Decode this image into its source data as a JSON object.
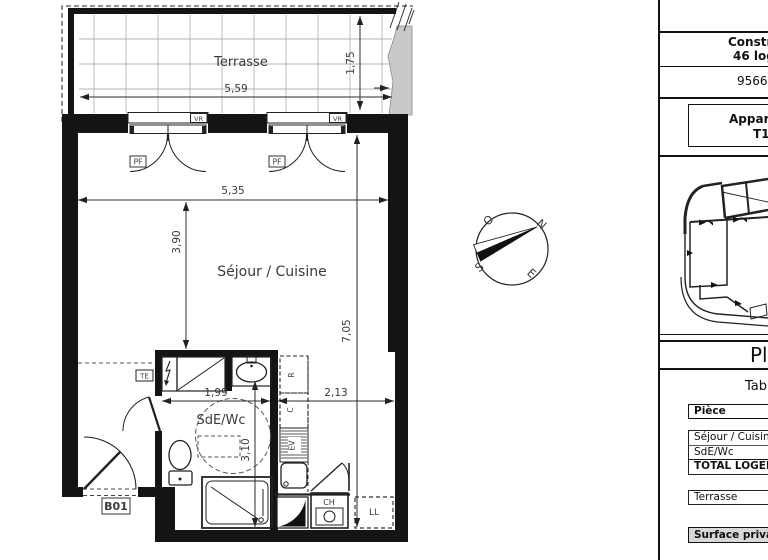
{
  "plan": {
    "room_labels": {
      "terrasse": "Terrasse",
      "sejour": "Séjour / Cuisine",
      "sde": "SdE/Wc"
    },
    "dims": {
      "terrace_w": "5,59",
      "terrace_d": "1,75",
      "living_w": "5,35",
      "living_d": "3,90",
      "total_d": "7,05",
      "sde_w": "1,99",
      "kitchen_w": "2,13",
      "sde_d": "3,10"
    },
    "tags": {
      "vr": "VR",
      "pf": "PF",
      "te": "TE",
      "fridge": "R",
      "c": "C",
      "ev": "EV",
      "ch": "CH",
      "ll": "LL",
      "unit": "B01"
    }
  },
  "compass": {
    "n": "N",
    "e": "E",
    "s": "S",
    "o": "O"
  },
  "panel": {
    "project": {
      "line1": "Constru",
      "line2": "46 log"
    },
    "address": "95660",
    "apartment": {
      "line1": "Appart",
      "line2": "T1 -"
    },
    "plan_title": "Pla",
    "table_title": "Tab",
    "surface_table": {
      "header": "Pièce",
      "rows": [
        "Séjour / Cuisine",
        "SdE/Wc"
      ],
      "total_row": "TOTAL LOGEMENT",
      "terrace_row": "Terrasse",
      "footer_row": "Surface privative"
    }
  }
}
